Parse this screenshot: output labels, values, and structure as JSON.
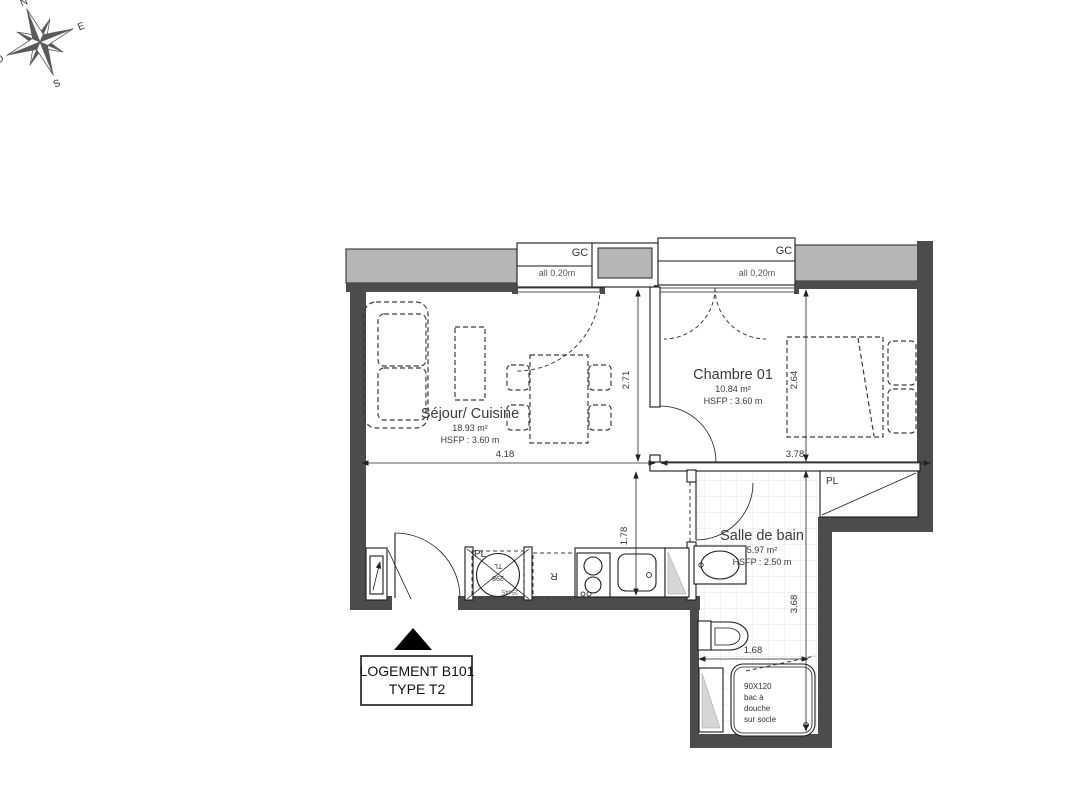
{
  "compass": {
    "north": "N",
    "east": "E",
    "south": "S",
    "west": "O"
  },
  "openings": {
    "window1": {
      "label": "GC",
      "allege": "all 0.20m"
    },
    "window2": {
      "label": "GC",
      "allege": "all 0,20m"
    }
  },
  "rooms": [
    {
      "name": "Séjour/ Cuisine",
      "area": "18.93 m²",
      "height": "HSFP : 3.60 m"
    },
    {
      "name": "Chambre 01",
      "area": "10.84 m²",
      "height": "HSFP : 3.60 m"
    },
    {
      "name": "Salle de bain",
      "area": "5.97 m²",
      "height": "HSFP : 2.50 m"
    }
  ],
  "labels": {
    "kitchen_closet": "PL",
    "bath_closet": "PL",
    "fridge": "R",
    "washer_top": "TL",
    "washer_bottom": "298",
    "washer_size": "25x45",
    "shower": [
      "90X120",
      "bac à",
      "douche",
      "sur socle"
    ]
  },
  "dimensions": {
    "sejour_width": "4.18",
    "chambre_width": "3.78",
    "sejour_depth": "2.71",
    "chambre_depth": "2.64",
    "kitchen_depth": "1.78",
    "bath_depth": "3.68",
    "bath_width": "1.68"
  },
  "title_block": {
    "line1": "LOGEMENT B101",
    "line2": "TYPE T2"
  },
  "colors": {
    "wall_dark": "#4c4c4c",
    "wall_light": "#b6b6b6",
    "tile_line": "#dddddd",
    "text": "#3a3a3a"
  }
}
